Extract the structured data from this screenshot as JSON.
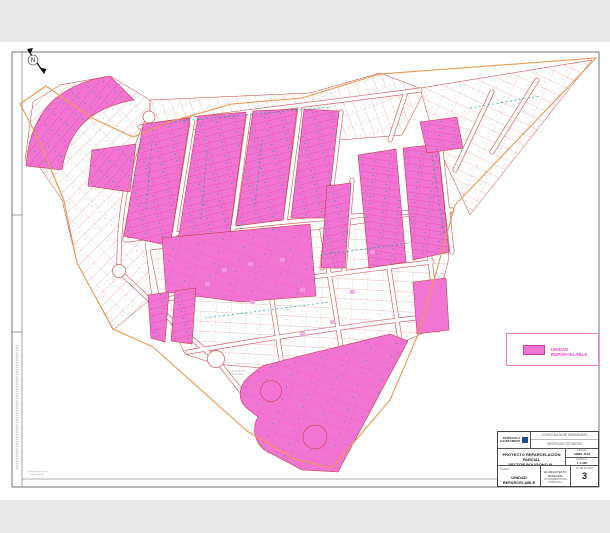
{
  "page": {
    "background": "#e9e9e9",
    "sheet_color": "#ffffff"
  },
  "map": {
    "north_label": "N",
    "colors": {
      "parcel_pink": "#f274d2",
      "parcel_line_red": "#c23b3b",
      "sector_boundary_orange": "#e89a50",
      "street_label_teal": "#00a6a6"
    }
  },
  "legend": {
    "swatch_color": "#f274d2",
    "label": "UNIDAD REPARCELABLE"
  },
  "titleblock": {
    "logo_name": "PEÑÍSCOLA",
    "logo_sub": "AJUNTAMENT",
    "dept_line1": "CONCEJALÍA DE URBANISMO",
    "dept_line2": "SERVICIOS TÉCNICOS",
    "project_line1": "PROYECTO REPARCELACIÓN PARCIAL",
    "project_line2": "SECTOR POLÍGONO III - PEÑÍSCOLA",
    "plano_label": "PLANO:",
    "plano_name": "UNIDAD REPARCELABLE",
    "fecha_label": "FECHA",
    "fecha_value": "ABRIL 2013",
    "escala_label": "ESCALA",
    "escala_value": "1:1.000",
    "signer": "EL ARQUITECTO MUNICIPAL",
    "signer_sub": "AYUNTAMIENTO DE PEÑÍSCOLA",
    "sheet_label": "Nº DE PLANO",
    "sheet_number": "3"
  }
}
